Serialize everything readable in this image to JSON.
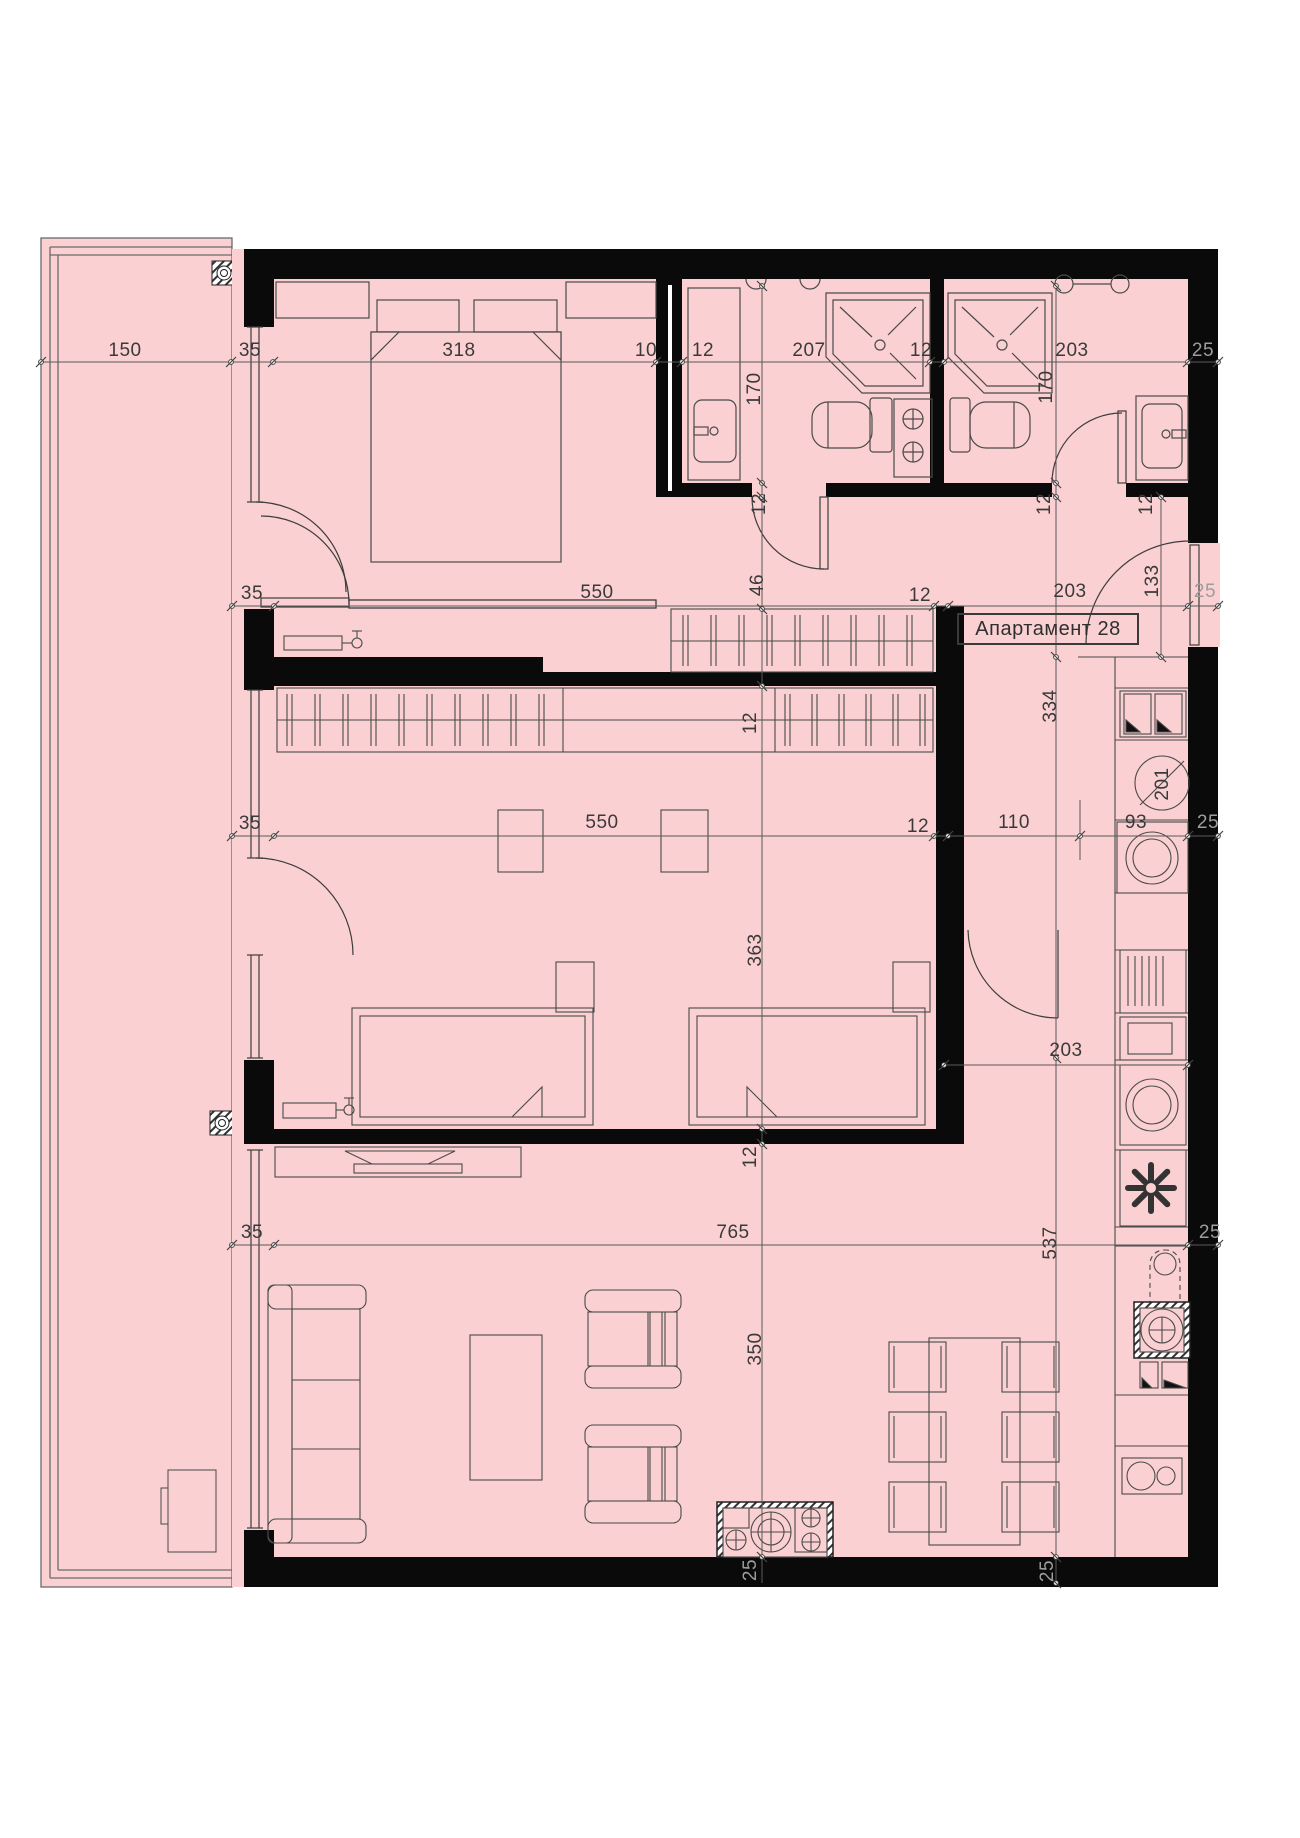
{
  "title": "Апартамент 28",
  "colors": {
    "room_fill": "#fad0d2",
    "wall": "#0a0a0a",
    "line": "#4a4a4a",
    "dim_text": "#3a3a3a",
    "dim_muted": "#9d9d9d",
    "background": "#ffffff"
  },
  "dim_labels": [
    {
      "t": "150",
      "x": 125,
      "y": 351
    },
    {
      "t": "35",
      "x": 250,
      "y": 351
    },
    {
      "t": "318",
      "x": 459,
      "y": 351
    },
    {
      "t": "10",
      "x": 646,
      "y": 351
    },
    {
      "t": "12",
      "x": 703,
      "y": 351
    },
    {
      "t": "207",
      "x": 809,
      "y": 351
    },
    {
      "t": "12",
      "x": 921,
      "y": 351
    },
    {
      "t": "203",
      "x": 1072,
      "y": 351
    },
    {
      "t": "25",
      "x": 1203,
      "y": 351,
      "gray": true
    },
    {
      "t": "35",
      "x": 252,
      "y": 594
    },
    {
      "t": "550",
      "x": 597,
      "y": 593
    },
    {
      "t": "12",
      "x": 920,
      "y": 596
    },
    {
      "t": "203",
      "x": 1070,
      "y": 592
    },
    {
      "t": "25",
      "x": 1205,
      "y": 592,
      "gray": true
    },
    {
      "t": "46",
      "x": 758,
      "y": 585,
      "rot": true
    },
    {
      "t": "133",
      "x": 1153,
      "y": 581,
      "rot": true
    },
    {
      "t": "35",
      "x": 250,
      "y": 824
    },
    {
      "t": "550",
      "x": 602,
      "y": 823
    },
    {
      "t": "12",
      "x": 918,
      "y": 827
    },
    {
      "t": "110",
      "x": 1014,
      "y": 823
    },
    {
      "t": "93",
      "x": 1136,
      "y": 823
    },
    {
      "t": "25",
      "x": 1208,
      "y": 823,
      "gray": true
    },
    {
      "t": "35",
      "x": 252,
      "y": 1233
    },
    {
      "t": "765",
      "x": 733,
      "y": 1233
    },
    {
      "t": "25",
      "x": 1210,
      "y": 1233,
      "gray": true
    },
    {
      "t": "537",
      "x": 1051,
      "y": 1243,
      "rot": true
    },
    {
      "t": "170",
      "x": 755,
      "y": 389,
      "rot": true
    },
    {
      "t": "12",
      "x": 760,
      "y": 504,
      "rot": true
    },
    {
      "t": "12",
      "x": 751,
      "y": 723,
      "rot": true
    },
    {
      "t": "363",
      "x": 756,
      "y": 950,
      "rot": true
    },
    {
      "t": "12",
      "x": 751,
      "y": 1157,
      "rot": true
    },
    {
      "t": "350",
      "x": 756,
      "y": 1349,
      "rot": true
    },
    {
      "t": "25",
      "x": 751,
      "y": 1570,
      "rot": true,
      "gray": true
    },
    {
      "t": "170",
      "x": 1047,
      "y": 387,
      "rot": true
    },
    {
      "t": "12",
      "x": 1045,
      "y": 504,
      "rot": true
    },
    {
      "t": "334",
      "x": 1051,
      "y": 706,
      "rot": true
    },
    {
      "t": "25",
      "x": 1048,
      "y": 1571,
      "rot": true,
      "gray": true
    },
    {
      "t": "12",
      "x": 1147,
      "y": 504,
      "rot": true
    },
    {
      "t": "203",
      "x": 1066,
      "y": 1051
    },
    {
      "t": "201",
      "x": 1163,
      "y": 784,
      "rot": true
    }
  ]
}
